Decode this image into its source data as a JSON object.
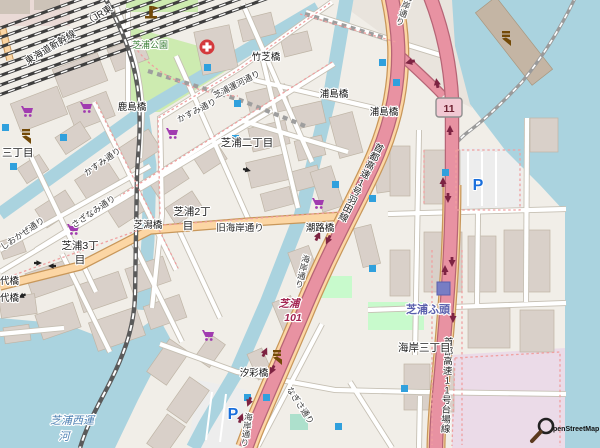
{
  "map": {
    "attribution": "penStreetMap",
    "route_shield_11": "11",
    "parking": "P",
    "exit": {
      "name": "芝浦",
      "number": "101"
    },
    "railways": {
      "shinkansen": "東海道新幹線",
      "jr_partial": "（JR東"
    },
    "expressways": {
      "haneda": "首都高速1号羽田線",
      "daiba": "首都高速11号台場線"
    },
    "streets": {
      "kasumi": "かすみ通り",
      "sazanami": "さざなみ通り",
      "shiokaze": "しおかぜ通り",
      "nagisa": "なぎさ通り",
      "unga": "芝浦運河通り",
      "kyu_kaigan": "旧海岸通り",
      "kaigan": "海岸通り"
    },
    "bridges": {
      "takeshiba": "竹芝橋",
      "kashima": "鹿島橋",
      "urashima": "浦島橋",
      "shibagata": "芝潟橋",
      "shioji": "潮路橋",
      "shiosai": "汐彩橋",
      "dai_partial": "代橋"
    },
    "districts": {
      "shibaura_2_kanji": "芝浦二丁目",
      "shibaura_2_l1": "芝浦2丁",
      "shibaura_2_l2": "目",
      "shibaura_3_l1": "芝浦3丁",
      "shibaura_3_l2": "目",
      "sanchome_partial": "三丁目",
      "kaigan_3": "海岸三丁目"
    },
    "places": {
      "park": "芝浦公園",
      "station": "芝浦ふ頭",
      "canal_l1": "芝浦西運",
      "canal_l2": "河"
    },
    "icons": {
      "supermarket-icon": "purple shopping cart",
      "hospital-icon": "white cross on red circle",
      "parking-icon": "blue P",
      "station-icon": "indigo square",
      "poi-icon": "small blue square",
      "crane-icon": "brown man-made marker",
      "monument-icon": "brown monument",
      "oneway-arrow-icon": "one-way arrow",
      "osm-magnifier-icon": "magnifying glass"
    },
    "colors": {
      "water": "#aad3df",
      "land": "#f1eee8",
      "motorway": "#e892a2",
      "primary_road": "#fcd6a4",
      "industrial": "#ebdbe8",
      "park": "#cdebb0",
      "building": "#d9d0c9",
      "parking_blue": "#1a6fdc",
      "station_text": "#5a60ad",
      "water_text": "#4d80b3",
      "exit_text": "#a32552",
      "park_text": "#3c8039"
    }
  }
}
